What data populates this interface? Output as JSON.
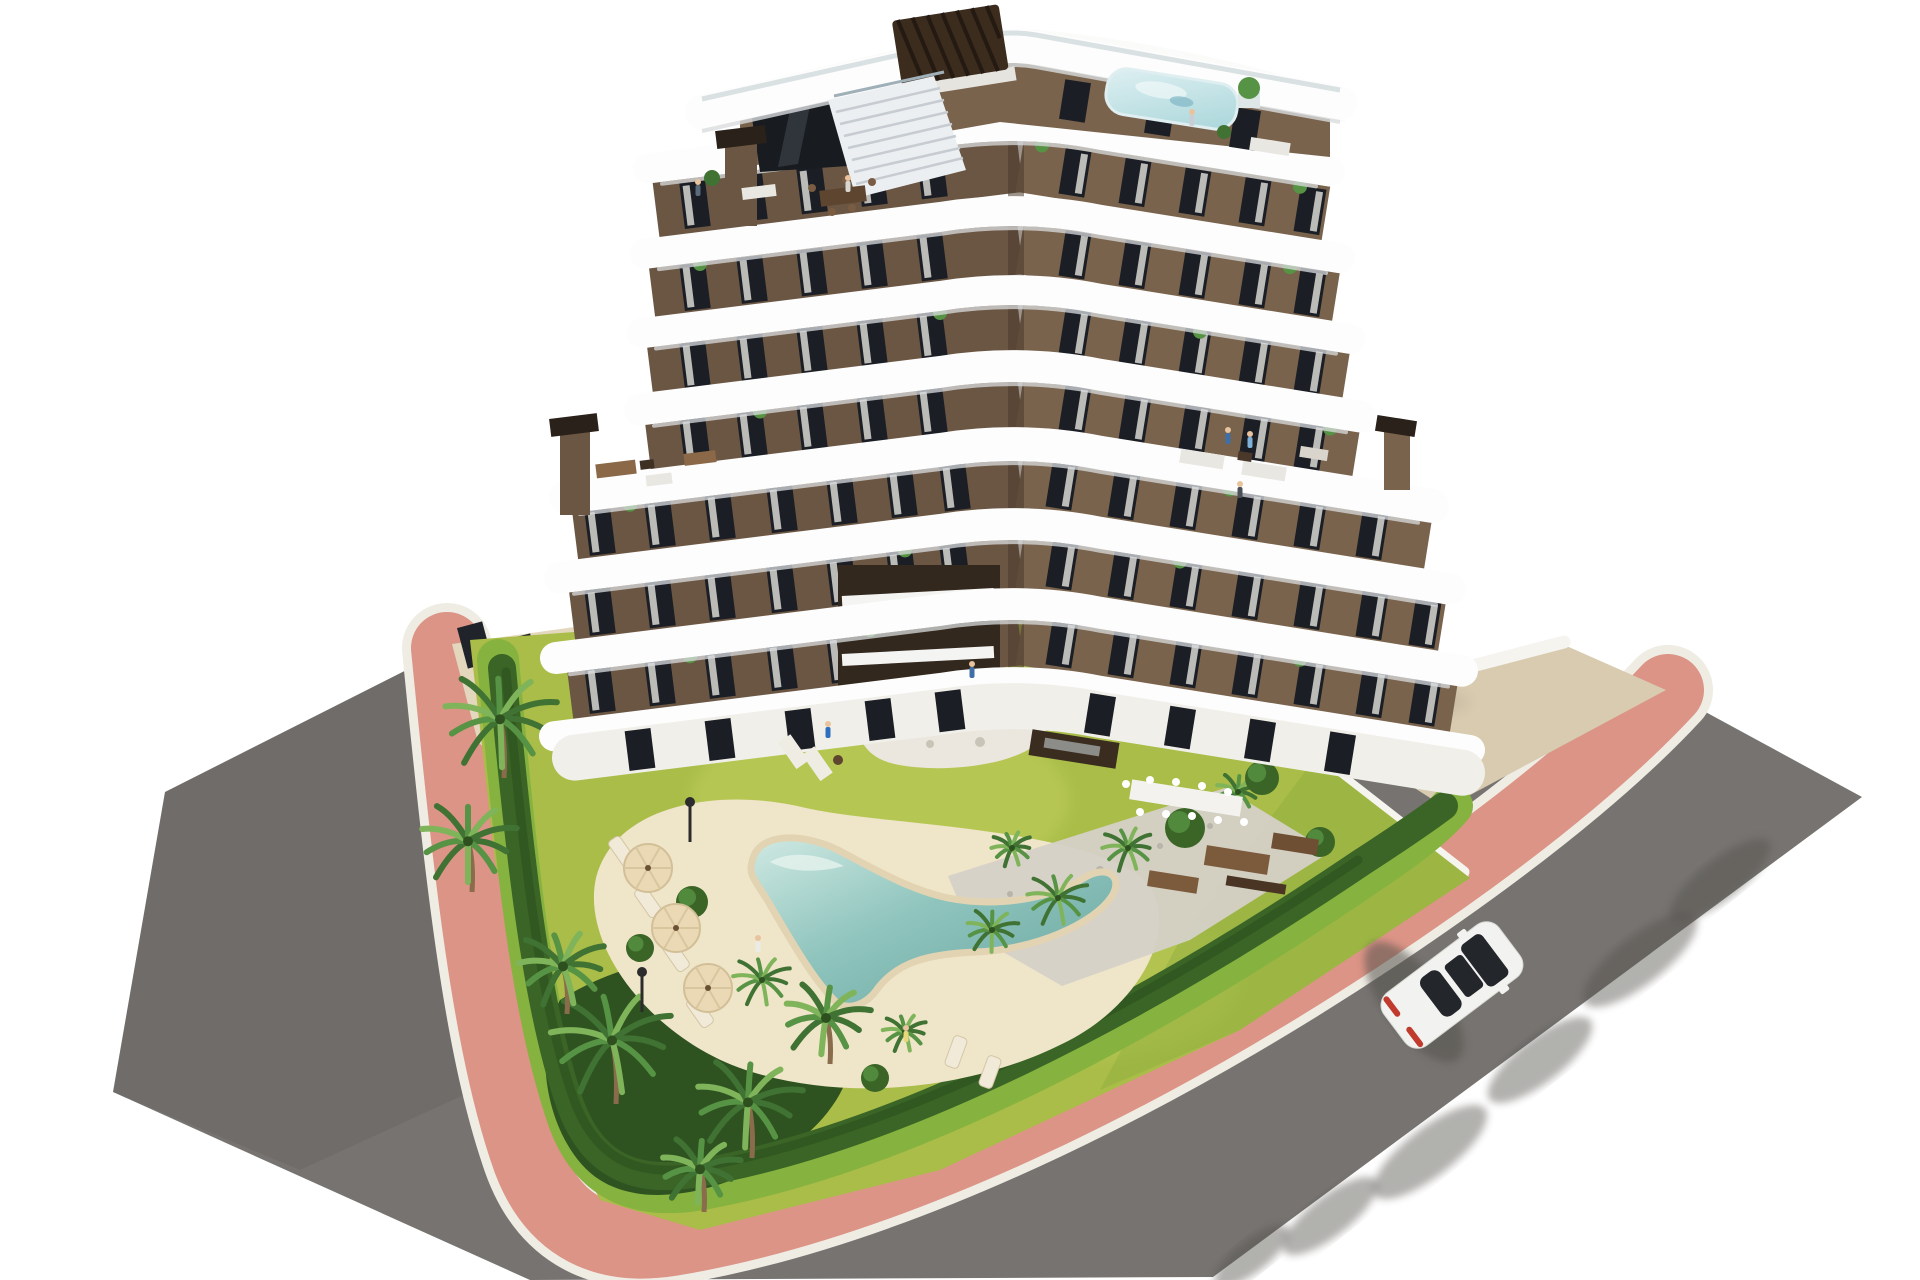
{
  "meta": {
    "type": "3d-architectural-rendering",
    "subject": "aerial view of a modern apartment building with communal garden and lagoon pool",
    "visible_text": "none",
    "elements": [
      "stepped white wavy balconies",
      "brown facade with tall windows",
      "rooftop terrace with pergola and plunge pool",
      "roof terraces with outdoor furniture",
      "communal lawn garden",
      "lagoon-style pool with sand beach",
      "palm trees and hedges",
      "pink paved sidewalk",
      "asphalt roads",
      "white car driving on road"
    ]
  },
  "palette": {
    "bg": "#ffffff",
    "road": "#767370",
    "roadDark": "#6b6966",
    "shadow": "#54524e",
    "curb": "#efece4",
    "pink": "#dc9486",
    "lawn": "#a9bd48",
    "lawnLight": "#c3cf5e",
    "lawnDark": "#8fae3e",
    "verge": "#86b23f",
    "hedge": "#3a6526",
    "hedgeDark": "#2c501d",
    "bed": "#2e5320",
    "palmDark": "#3f7233",
    "palmMid": "#579344",
    "palmLight": "#7fb45a",
    "trunk": "#8a6b4c",
    "sand": "#efe5c9",
    "sandEdge": "#e2d4b2",
    "poolEdge": "#cfe9e2",
    "poolDeep": "#68a49e",
    "gravel": "#d5d1c8",
    "tan": "#d8cbb0",
    "tanLight": "#e3d7bd",
    "band": "#fdfdfd",
    "bandShadow": "#d9dcdf",
    "facadeL": "#6a5643",
    "facadeR": "#79634c",
    "facadeDeep": "#4b3a2b",
    "window": "#1b1e24",
    "curtain": "#e4e2dd",
    "pergola": "#3c2c1e",
    "wall": "#f6f4ef",
    "carBody": "#f2f2f0",
    "carGlass": "#23262b",
    "carTail": "#c03a2e",
    "stone": "#ebe7de",
    "furnWood": "#8a6848",
    "furnWhite": "#e9e7e2"
  },
  "building": {
    "apexX": 1020,
    "slopeL": 0.125,
    "slopeR": 0.16,
    "bands": [
      {
        "apexY": 122,
        "h": 30,
        "left": 648,
        "right": 1330
      },
      {
        "apexY": 207,
        "h": 30,
        "left": 645,
        "right": 1340
      },
      {
        "apexY": 286,
        "h": 30,
        "left": 642,
        "right": 1350
      },
      {
        "apexY": 362,
        "h": 32,
        "left": 640,
        "right": 1360
      },
      {
        "apexY": 440,
        "h": 34,
        "left": 566,
        "right": 1432
      },
      {
        "apexY": 520,
        "h": 32,
        "left": 560,
        "right": 1450
      },
      {
        "apexY": 600,
        "h": 32,
        "left": 556,
        "right": 1462
      },
      {
        "apexY": 678,
        "h": 30,
        "left": 554,
        "right": 1470
      }
    ],
    "facades": [
      {
        "cy": 164,
        "h": 56,
        "left": 656,
        "right": 1326,
        "winL": [
          695,
          752,
          812,
          872,
          932
        ],
        "winR": [
          1075,
          1135,
          1195,
          1255,
          1310
        ],
        "plants": [
          1042,
          1300
        ]
      },
      {
        "cy": 246,
        "h": 56,
        "left": 652,
        "right": 1336,
        "winL": [
          695,
          752,
          812,
          872,
          932
        ],
        "winR": [
          1075,
          1135,
          1195,
          1255,
          1310
        ],
        "plants": [
          700,
          1290
        ]
      },
      {
        "cy": 324,
        "h": 54,
        "left": 650,
        "right": 1346,
        "winL": [
          695,
          752,
          812,
          872,
          932
        ],
        "winR": [
          1075,
          1135,
          1195,
          1255,
          1310
        ],
        "plants": [
          940,
          1200
        ]
      },
      {
        "cy": 400,
        "h": 54,
        "left": 648,
        "right": 1356,
        "winL": [
          695,
          752,
          812,
          872,
          932
        ],
        "winR": [
          1075,
          1135,
          1195,
          1255,
          1310
        ],
        "plants": [
          760,
          1330
        ]
      },
      {
        "cy": 479,
        "h": 58,
        "left": 575,
        "right": 1428,
        "winL": [
          600,
          660,
          720,
          782,
          842,
          902,
          955
        ],
        "winR": [
          1062,
          1124,
          1186,
          1248,
          1310,
          1372
        ],
        "plants": [
          630,
          1230
        ]
      },
      {
        "cy": 559,
        "h": 58,
        "left": 572,
        "right": 1442,
        "winL": [
          600,
          660,
          720,
          782,
          842,
          902,
          955
        ],
        "winR": [
          1062,
          1124,
          1186,
          1248,
          1310,
          1372,
          1425
        ],
        "plants": [
          905,
          1180
        ]
      },
      {
        "cy": 637,
        "h": 56,
        "left": 570,
        "right": 1454,
        "winL": [
          600,
          660,
          720,
          782,
          842,
          902,
          955
        ],
        "winR": [
          1062,
          1124,
          1186,
          1248,
          1310,
          1372,
          1425
        ],
        "plants": [
          690,
          1300
        ]
      }
    ],
    "ground": {
      "cy": 702,
      "h": 46,
      "left": 575,
      "right": 1462,
      "doorsL": [
        640,
        720,
        800,
        880,
        950
      ],
      "doorsR": [
        1100,
        1180,
        1260,
        1340
      ]
    },
    "window": {
      "w": 26,
      "h": 46,
      "angleL": -7.1,
      "angleR": 9.1
    },
    "floors_visible": 7
  },
  "garden": {
    "palms": [
      {
        "x": 500,
        "y": 772,
        "r": 66
      },
      {
        "x": 468,
        "y": 886,
        "r": 56
      },
      {
        "x": 948,
        "y": 704,
        "r": 84
      },
      {
        "x": 612,
        "y": 1098,
        "r": 72
      },
      {
        "x": 748,
        "y": 1152,
        "r": 62
      },
      {
        "x": 826,
        "y": 1058,
        "r": 50
      },
      {
        "x": 563,
        "y": 1008,
        "r": 52
      },
      {
        "x": 700,
        "y": 1206,
        "r": 46
      }
    ],
    "smallPalms": [
      {
        "x": 1058,
        "y": 898,
        "r": 36
      },
      {
        "x": 1128,
        "y": 848,
        "r": 30
      },
      {
        "x": 992,
        "y": 930,
        "r": 30
      },
      {
        "x": 762,
        "y": 980,
        "r": 34
      },
      {
        "x": 1238,
        "y": 792,
        "r": 26
      },
      {
        "x": 905,
        "y": 1032,
        "r": 26
      },
      {
        "x": 1012,
        "y": 848,
        "r": 24
      }
    ],
    "bushes": [
      {
        "x": 1185,
        "y": 828,
        "r": 20
      },
      {
        "x": 1262,
        "y": 778,
        "r": 17
      },
      {
        "x": 692,
        "y": 902,
        "r": 16
      },
      {
        "x": 1320,
        "y": 842,
        "r": 15
      },
      {
        "x": 875,
        "y": 1078,
        "r": 14
      },
      {
        "x": 640,
        "y": 948,
        "r": 14
      }
    ],
    "umbrellas": [
      {
        "x": 648,
        "y": 868
      },
      {
        "x": 676,
        "y": 928
      },
      {
        "x": 708,
        "y": 988
      }
    ],
    "loungers": [
      {
        "x": 622,
        "y": 852,
        "a": -35
      },
      {
        "x": 648,
        "y": 902,
        "a": -35
      },
      {
        "x": 676,
        "y": 956,
        "a": -35
      },
      {
        "x": 700,
        "y": 1012,
        "a": -35
      },
      {
        "x": 956,
        "y": 1052,
        "a": 20
      },
      {
        "x": 990,
        "y": 1072,
        "a": 20
      }
    ],
    "lamps": [
      {
        "x": 690,
        "y": 842
      },
      {
        "x": 642,
        "y": 1012
      }
    ]
  },
  "street": {
    "treeShadows": [
      {
        "x": 1720,
        "y": 880,
        "rx": 62,
        "ry": 20
      },
      {
        "x": 1640,
        "y": 960,
        "rx": 70,
        "ry": 24
      },
      {
        "x": 1540,
        "y": 1060,
        "rx": 64,
        "ry": 22
      },
      {
        "x": 1430,
        "y": 1152,
        "rx": 70,
        "ry": 24
      },
      {
        "x": 1330,
        "y": 1216,
        "rx": 58,
        "ry": 20
      },
      {
        "x": 1252,
        "y": 1256,
        "rx": 46,
        "ry": 16
      }
    ]
  },
  "vehicle": {
    "cx": 1452,
    "cy": 985,
    "angle": 53,
    "color": "white",
    "state": "driving"
  },
  "people": [
    {
      "x": 698,
      "y": 196,
      "c": "#5a6b7c"
    },
    {
      "x": 848,
      "y": 192,
      "c": "#d8d6d1"
    },
    {
      "x": 1192,
      "y": 126,
      "c": "#c9ced5"
    },
    {
      "x": 1228,
      "y": 444,
      "c": "#3f6fa8"
    },
    {
      "x": 1250,
      "y": 448,
      "c": "#7fb0d8"
    },
    {
      "x": 1240,
      "y": 498,
      "c": "#4a5058"
    },
    {
      "x": 972,
      "y": 678,
      "c": "#3f6fa8"
    },
    {
      "x": 828,
      "y": 738,
      "c": "#2f6fbf"
    },
    {
      "x": 758,
      "y": 952,
      "c": "#eceae4"
    },
    {
      "x": 906,
      "y": 1042,
      "c": "#e8d87a"
    }
  ]
}
